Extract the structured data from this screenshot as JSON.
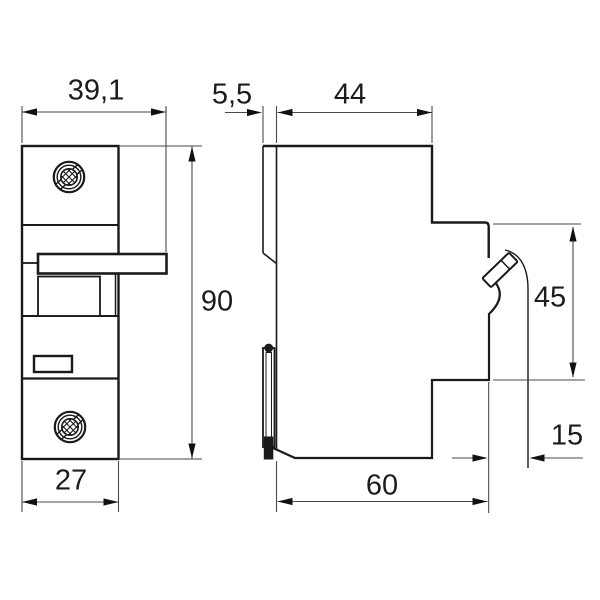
{
  "dimensions": {
    "front_overall_width": "39,1",
    "front_height": "90",
    "front_body_width": "27",
    "side_front_panel_depth": "5,5",
    "side_upper_depth": "44",
    "side_rear_height": "45",
    "side_hook_depth": "15",
    "side_lower_depth": "60"
  },
  "colors": {
    "outline": "#1a1a1a",
    "dimension_line": "#4a4a4a",
    "background": "#ffffff"
  }
}
